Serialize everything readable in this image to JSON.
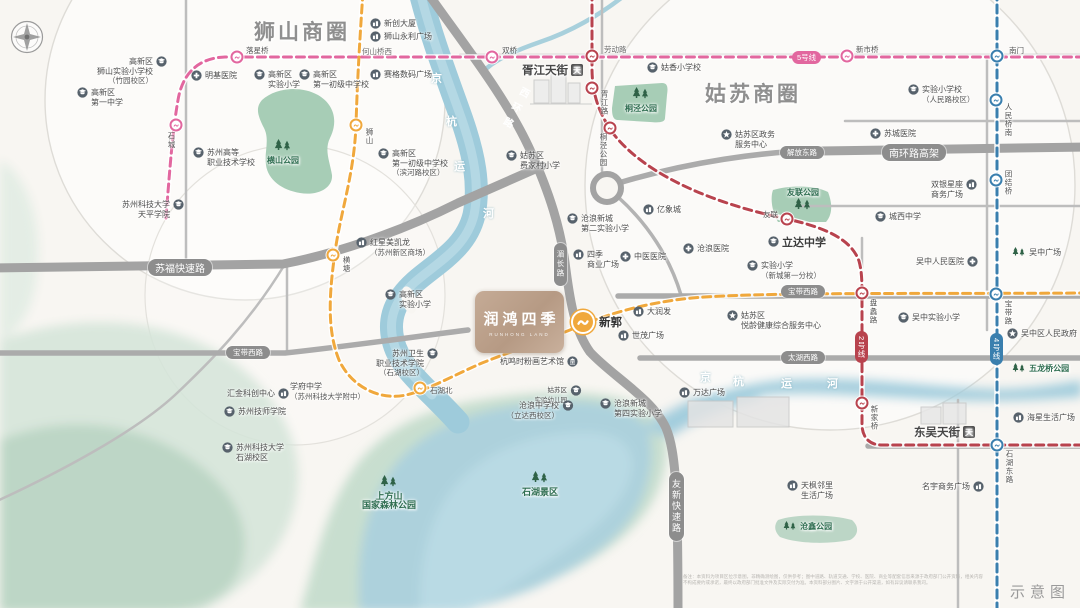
{
  "note": "示意图",
  "disclaimer": "备注：本资料为项目区位示意图，非精确测绘图，仅供参考；图中道路、轨道交通、学校、医院、商业等配套信息来源于政府部门公开资料，相关内容不构成要约或承诺，最终以政府部门批准文件及实际交付为准。本资料部分图片、文字源于公开渠道，如有异议请联系我司。",
  "brand": {
    "name": "润鸿四季",
    "subtitle_en": "RUNHONG LAND",
    "color": "#bda08b"
  },
  "business_circles": [
    {
      "label": "狮山商圈"
    },
    {
      "label": "姑苏商圈"
    }
  ],
  "colors": {
    "line5_pink": "#e2679f",
    "line2_red": "#b8434e",
    "line4_blue": "#3a7fae",
    "line_orange": "#f0a83c",
    "road_gray": "#a6a6a6",
    "park_green": "#a7cdb6",
    "river_teal": "#9ecbdb",
    "label_green": "#2f6e51"
  },
  "river": {
    "name": "京杭运河",
    "chars": [
      {
        "c": "京",
        "x": 431,
        "y": 70
      },
      {
        "c": "杭",
        "x": 446,
        "y": 113
      },
      {
        "c": "运",
        "x": 454,
        "y": 158
      },
      {
        "c": "河",
        "x": 483,
        "y": 205
      },
      {
        "c": "京",
        "x": 700,
        "y": 369
      },
      {
        "c": "杭",
        "x": 733,
        "y": 373
      },
      {
        "c": "运",
        "x": 781,
        "y": 375
      },
      {
        "c": "河",
        "x": 827,
        "y": 375
      }
    ]
  },
  "roads": {
    "pills": [
      {
        "n": "road-sufu-expressway",
        "text": "苏福快速路",
        "x": 148,
        "y": 259,
        "fs": 10
      },
      {
        "n": "road-nanhuan-viaduct",
        "text": "南环路高架",
        "x": 882,
        "y": 144,
        "fs": 10
      },
      {
        "n": "road-jiefang-east",
        "text": "解放东路",
        "x": 780,
        "y": 146,
        "fs": 7.5
      },
      {
        "n": "road-baodai-west-e",
        "text": "宝带西路",
        "x": 781,
        "y": 285,
        "fs": 7.5
      },
      {
        "n": "road-baodai-west-w",
        "text": "宝带西路",
        "x": 226,
        "y": 346,
        "fs": 7.5
      },
      {
        "n": "road-taihu-west",
        "text": "太湖西路",
        "x": 781,
        "y": 351,
        "fs": 7.5
      },
      {
        "n": "road-meichang",
        "text": "湄长路",
        "x": 554,
        "y": 243,
        "fs": 7.5,
        "v": 1
      },
      {
        "n": "road-youxin-expressway",
        "text": "友新快速路",
        "x": 669,
        "y": 472,
        "fs": 9,
        "v": 1
      }
    ],
    "rotated": [
      {
        "n": "road-xihuan",
        "text": "西环路",
        "x": 506,
        "y": 84,
        "rot": 28
      }
    ],
    "plain": [
      {
        "n": "road-laodong",
        "text": "劳动路",
        "x": 604,
        "y": 44
      },
      {
        "n": "label-heshanqiao-west",
        "text": "何山桥西",
        "x": 362,
        "y": 46
      }
    ]
  },
  "metro": {
    "badges": [
      {
        "n": "badge-line-5",
        "text": "5号线",
        "x": 792,
        "y": 51,
        "color": "#e2679f"
      },
      {
        "n": "badge-line-2",
        "text": "2号线",
        "x": 855,
        "y": 331,
        "color": "#b8434e",
        "v": 1
      },
      {
        "n": "badge-line-4",
        "text": "4号线",
        "x": 990,
        "y": 333,
        "color": "#3a7fae",
        "v": 1
      }
    ],
    "stations": [
      {
        "n": "station-shicheng",
        "x": 176,
        "y": 125,
        "line": "#e2679f",
        "lb": "石城",
        "lx": 166,
        "ly": 132,
        "v": 1
      },
      {
        "n": "station-luoxingqiao",
        "x": 237,
        "y": 57,
        "line": "#e2679f",
        "lb": "落星桥",
        "lx": 246,
        "ly": 45
      },
      {
        "n": "station-shuangqiao",
        "x": 492,
        "y": 57,
        "line": "#e2679f",
        "lb": "双桥",
        "lx": 502,
        "ly": 45
      },
      {
        "n": "station-xinshiqiao",
        "x": 847,
        "y": 56,
        "line": "#e2679f",
        "lb": "新市桥",
        "lx": 856,
        "ly": 44
      },
      {
        "n": "station-laodonglu",
        "x": 592,
        "y": 56,
        "line": "#b8434e",
        "lb": "劳动路",
        "lx": 999,
        "ly": -999
      },
      {
        "n": "station-xujianglu",
        "x": 592,
        "y": 88,
        "line": "#b8434e",
        "lb": "胥江路",
        "lx": 599,
        "ly": 90,
        "v": 1
      },
      {
        "n": "station-tongjing-park",
        "x": 610,
        "y": 128,
        "line": "#b8434e",
        "lb": "桐泾公园",
        "lx": 598,
        "ly": 133,
        "v": 1
      },
      {
        "n": "station-youlian",
        "x": 787,
        "y": 219,
        "line": "#b8434e",
        "lb": "友联",
        "lx": 763,
        "ly": 209
      },
      {
        "n": "station-panlilu",
        "x": 862,
        "y": 293,
        "line": "#b8434e",
        "lb": "盘蠡路",
        "lx": 868,
        "ly": 299,
        "v": 1
      },
      {
        "n": "station-xinjiaqiao",
        "x": 862,
        "y": 403,
        "line": "#b8434e",
        "lb": "新家桥",
        "lx": 869,
        "ly": 405,
        "v": 1
      },
      {
        "n": "station-nanmen",
        "x": 997,
        "y": 56,
        "line": "#3a7fae",
        "lb": "南门",
        "lx": 1009,
        "ly": 45
      },
      {
        "n": "station-renminqiao-south",
        "x": 996,
        "y": 100,
        "line": "#3a7fae",
        "lb": "人民桥南",
        "lx": 1003,
        "ly": 103,
        "v": 1
      },
      {
        "n": "station-tuanjieqiao",
        "x": 996,
        "y": 180,
        "line": "#3a7fae",
        "lb": "团结桥",
        "lx": 1003,
        "ly": 170,
        "v": 1
      },
      {
        "n": "station-baodailu",
        "x": 996,
        "y": 294,
        "line": "#3a7fae",
        "lb": "宝带路",
        "lx": 1003,
        "ly": 300,
        "v": 1
      },
      {
        "n": "station-shihu-east-rd",
        "x": 997,
        "y": 445,
        "line": "#3a7fae",
        "lb": "石湖东路",
        "lx": 1004,
        "ly": 450,
        "v": 1
      },
      {
        "n": "station-shishan",
        "x": 356,
        "y": 125,
        "line": "#f0a83c",
        "lb": "狮山",
        "lx": 364,
        "ly": 128,
        "v": 1
      },
      {
        "n": "station-hengtang",
        "x": 333,
        "y": 255,
        "line": "#f0a83c",
        "lb": "横塘",
        "lx": 341,
        "ly": 256,
        "v": 1
      },
      {
        "n": "station-shihubei",
        "x": 420,
        "y": 388,
        "line": "#f0a83c",
        "lb": "石湖北",
        "lx": 430,
        "ly": 385
      },
      {
        "n": "station-xinguo",
        "x": 583,
        "y": 322,
        "line": "#f0a83c",
        "big": 1,
        "lb": "新郭",
        "lx": 599,
        "ly": 314,
        "biglb": 1
      }
    ]
  },
  "tianjie_malls": [
    {
      "n": "mall-xujiang-tianjie",
      "label": "胥江天街",
      "x": 522,
      "y": 62
    },
    {
      "n": "mall-dongwu-tianjie",
      "label": "东吴天街",
      "x": 914,
      "y": 424
    }
  ],
  "pois": [
    {
      "n": "xinchuang-tower",
      "x": 370,
      "y": 19,
      "t": "mall",
      "lines": [
        "新创大厦"
      ]
    },
    {
      "n": "shishan-yongli-plaza",
      "x": 370,
      "y": 32,
      "t": "mall",
      "lines": [
        "狮山永利广场"
      ]
    },
    {
      "n": "saige-digital-plaza",
      "x": 370,
      "y": 70,
      "t": "mall",
      "lines": [
        "赛格数码广场"
      ]
    },
    {
      "n": "mingji-hospital",
      "x": 191,
      "y": 71,
      "t": "hosp",
      "lines": [
        "明基医院"
      ]
    },
    {
      "n": "gaoxin-shishan-exp-primary",
      "x": 167,
      "y": 57,
      "t": "school",
      "side": "r",
      "al": "r",
      "lines": [
        "高新区",
        "狮山实验小学校",
        "（竹园校区）"
      ]
    },
    {
      "n": "gaoxin-no1-middle",
      "x": 77,
      "y": 88,
      "t": "school",
      "lines": [
        "高新区",
        "第一中学"
      ]
    },
    {
      "n": "gaoxin-exp-primary-north",
      "x": 254,
      "y": 70,
      "t": "school",
      "lines": [
        "高新区",
        "实验小学"
      ]
    },
    {
      "n": "gaoxin-no1-junior-north",
      "x": 299,
      "y": 70,
      "t": "school",
      "lines": [
        "高新区",
        "第一初级中学校"
      ]
    },
    {
      "n": "suzhou-higher-vocational",
      "x": 193,
      "y": 148,
      "t": "school",
      "lines": [
        "苏州高等",
        "职业技术学校"
      ]
    },
    {
      "n": "hengshan-park-label",
      "x": 283,
      "y": 140,
      "t": "trees",
      "al": "c",
      "green": 1,
      "lines": [
        "横山公园"
      ],
      "col": 1
    },
    {
      "n": "keda-tianping-college",
      "x": 184,
      "y": 200,
      "t": "school",
      "side": "r",
      "al": "r",
      "lines": [
        "苏州科技大学",
        "天平学院"
      ]
    },
    {
      "n": "gaoxin-no1-junior-binhe",
      "x": 378,
      "y": 149,
      "t": "school",
      "lines": [
        "高新区",
        "第一初级中学校",
        "（滨河路校区）"
      ]
    },
    {
      "n": "feijiacun-primary",
      "x": 506,
      "y": 151,
      "t": "school",
      "lines": [
        "姑苏区",
        "费家村小学"
      ]
    },
    {
      "n": "guxiang-primary",
      "x": 647,
      "y": 63,
      "t": "school",
      "lines": [
        "姑香小学校"
      ]
    },
    {
      "n": "tongjing-park-label",
      "x": 641,
      "y": 88,
      "t": "trees",
      "al": "c",
      "green": 1,
      "lines": [
        "桐泾公园"
      ],
      "col": 1
    },
    {
      "n": "yixiangcheng-mall",
      "x": 643,
      "y": 205,
      "t": "mall",
      "lines": [
        "亿象城"
      ]
    },
    {
      "n": "canglang-no2-exp-primary",
      "x": 567,
      "y": 214,
      "t": "school",
      "lines": [
        "沧浪新城",
        "第二实验小学"
      ]
    },
    {
      "n": "siji-commercial-plaza",
      "x": 573,
      "y": 250,
      "t": "mall",
      "lines": [
        "四季",
        "商业广场"
      ]
    },
    {
      "n": "zhongyi-hospital",
      "x": 620,
      "y": 252,
      "t": "hosp",
      "lines": [
        "中医医院"
      ]
    },
    {
      "n": "canglang-hospital",
      "x": 683,
      "y": 244,
      "t": "hosp",
      "lines": [
        "沧浪医院"
      ]
    },
    {
      "n": "redstar-macalline",
      "x": 356,
      "y": 238,
      "t": "mall",
      "lines": [
        "红星美凯龙",
        "（苏州新区商场）"
      ]
    },
    {
      "n": "gaoxin-exp-primary-center",
      "x": 385,
      "y": 290,
      "t": "school",
      "lines": [
        "高新区",
        "实验小学"
      ]
    },
    {
      "n": "lida-middle-school",
      "x": 768,
      "y": 237,
      "t": "school",
      "bold": 1,
      "lines": [
        "立达中学"
      ]
    },
    {
      "n": "exp-primary-xincheng-no1",
      "x": 747,
      "y": 261,
      "t": "school",
      "lines": [
        "实验小学",
        "（新城第一分校）"
      ]
    },
    {
      "n": "chengxi-middle-school",
      "x": 875,
      "y": 212,
      "t": "school",
      "lines": [
        "城西中学"
      ]
    },
    {
      "n": "wuzhong-renmin-hospital",
      "x": 916,
      "y": 257,
      "t": "hosp",
      "side": "r",
      "lines": [
        "吴中人民医院"
      ]
    },
    {
      "n": "wuzhong-plaza",
      "x": 1012,
      "y": 248,
      "t": "trees2",
      "lines": [
        "吴中广场"
      ]
    },
    {
      "n": "shuangyin-xingzuo-plaza",
      "x": 931,
      "y": 180,
      "t": "mall",
      "side": "r",
      "lines": [
        "双银星座",
        "商务广场"
      ]
    },
    {
      "n": "gusu-gov-service-center",
      "x": 721,
      "y": 130,
      "t": "gov",
      "lines": [
        "姑苏区政务",
        "服务中心"
      ]
    },
    {
      "n": "youlian-park-label",
      "x": 803,
      "y": 188,
      "t": "trees",
      "al": "c",
      "green": 1,
      "lines": [
        "友联公园"
      ],
      "col": 1,
      "treesbelow": 1
    },
    {
      "n": "exp-primary-renminlu",
      "x": 908,
      "y": 85,
      "t": "school",
      "lines": [
        "实验小学校",
        "（人民路校区）"
      ]
    },
    {
      "n": "sucheng-hospital",
      "x": 870,
      "y": 129,
      "t": "hosp",
      "lines": [
        "苏城医院"
      ]
    },
    {
      "n": "wuzhong-exp-primary",
      "x": 898,
      "y": 313,
      "t": "school",
      "lines": [
        "吴中实验小学"
      ]
    },
    {
      "n": "wuzhong-district-gov",
      "x": 1007,
      "y": 329,
      "t": "gov",
      "lines": [
        "吴中区人民政府"
      ]
    },
    {
      "n": "wulongqiao-park-label",
      "x": 1012,
      "y": 364,
      "t": "trees2",
      "green": 1,
      "lines": [
        "五龙桥公园"
      ]
    },
    {
      "n": "yueling-health-center",
      "x": 727,
      "y": 311,
      "t": "gov",
      "lines": [
        "姑苏区",
        "悦龄健康综合服务中心"
      ]
    },
    {
      "n": "rt-mart",
      "x": 633,
      "y": 307,
      "t": "mall",
      "lines": [
        "大润发"
      ]
    },
    {
      "n": "shimao-plaza",
      "x": 618,
      "y": 331,
      "t": "mall",
      "lines": [
        "世茂广场"
      ]
    },
    {
      "n": "wanda-plaza",
      "x": 679,
      "y": 388,
      "t": "mall",
      "lines": [
        "万达广场"
      ]
    },
    {
      "n": "hangmingshi-art-museum",
      "x": 500,
      "y": 357,
      "t": "museum",
      "side": "r",
      "lines": [
        "杭鸣时粉画艺术馆"
      ]
    },
    {
      "n": "weisheng-vocational-college",
      "x": 438,
      "y": 349,
      "t": "school",
      "side": "r",
      "al": "r",
      "lines": [
        "苏州卫生",
        "职业技术学院",
        "（石湖校区）"
      ]
    },
    {
      "n": "gusu-exp-kindergarten",
      "x": 581,
      "y": 386,
      "t": "school",
      "side": "r",
      "al": "r",
      "fs": 6.5,
      "lines": [
        "姑苏区",
        "实验幼儿园"
      ]
    },
    {
      "n": "canglang-middle-lida-west",
      "x": 573,
      "y": 401,
      "t": "school",
      "side": "r",
      "al": "r",
      "lines": [
        "沧浪中学校",
        "（立达西校区）"
      ]
    },
    {
      "n": "canglang-no4-exp-primary",
      "x": 600,
      "y": 399,
      "t": "school",
      "lines": [
        "沧浪新城",
        "第四实验小学"
      ]
    },
    {
      "n": "suzhou-jishi-college",
      "x": 224,
      "y": 407,
      "t": "school",
      "lines": [
        "苏州技师学院"
      ]
    },
    {
      "n": "keda-shihu-campus",
      "x": 222,
      "y": 443,
      "t": "school",
      "lines": [
        "苏州科技大学",
        "石湖校区"
      ]
    },
    {
      "n": "huijin-tech-center",
      "x": 227,
      "y": 389,
      "t": "mall",
      "side": "r",
      "lines": [
        "汇金科创中心"
      ]
    },
    {
      "n": "xuefu-middle-school",
      "x": 290,
      "y": 382,
      "t": "none",
      "lines": [
        "学府中学",
        "（苏州科技大学附中）"
      ]
    },
    {
      "n": "shangfangshan-forest-park-label",
      "x": 389,
      "y": 476,
      "t": "trees",
      "al": "c",
      "green": 1,
      "fs": 9,
      "lines": [
        "上方山",
        "国家森林公园"
      ],
      "col": 1
    },
    {
      "n": "shihu-scenic-label",
      "x": 540,
      "y": 472,
      "t": "trees",
      "al": "c",
      "green": 1,
      "fs": 9,
      "lines": [
        "石湖景区"
      ],
      "col": 1
    },
    {
      "n": "tianfeng-linli-plaza",
      "x": 787,
      "y": 481,
      "t": "mall",
      "lines": [
        "天枫邻里",
        "生活广场"
      ]
    },
    {
      "n": "cangxin-park-label",
      "x": 783,
      "y": 522,
      "t": "trees2",
      "green": 1,
      "lines": [
        "沧鑫公园"
      ]
    },
    {
      "n": "mingyu-business-plaza",
      "x": 922,
      "y": 482,
      "t": "mall",
      "side": "r",
      "lines": [
        "名宇商务广场"
      ]
    },
    {
      "n": "haixing-life-plaza",
      "x": 1013,
      "y": 413,
      "t": "mall",
      "lines": [
        "海星生活广场"
      ]
    }
  ]
}
